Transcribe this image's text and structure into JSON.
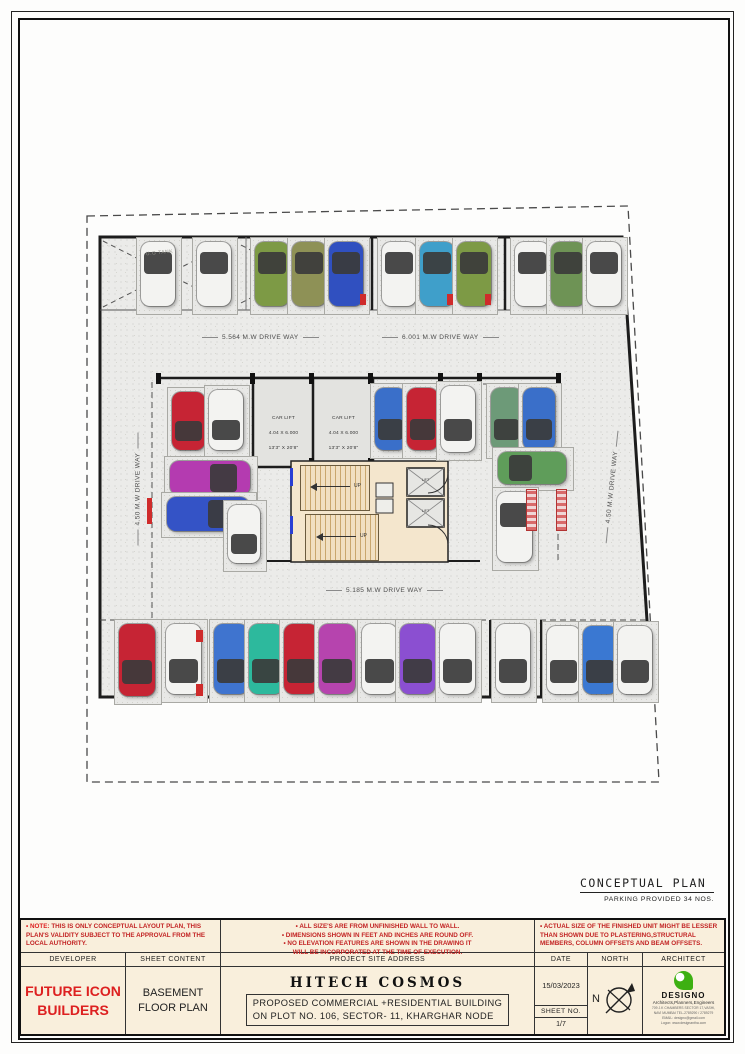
{
  "plan": {
    "conceptual_title": "CONCEPTUAL PLAN",
    "parking_note": "PARKING PROVIDED 34 NOS.",
    "tank_label": "U.G TANK",
    "up_label": "UP",
    "lift_label": "LIFT",
    "car_lift": {
      "line1": "CAR LIFT",
      "line2": "4.04 X 6.000",
      "line3": "13'3\" X 20'8\""
    },
    "driveways": [
      {
        "text": "5.564 M.W DRIVE WAY"
      },
      {
        "text": "6.001 M.W DRIVE WAY"
      },
      {
        "text": "4.50 M.W DRIVE WAY"
      },
      {
        "text": "4.50 M.W DRIVE WAY"
      },
      {
        "text": "5.185 M.W DRIVE WAY"
      }
    ],
    "cars": [
      {
        "x": 141,
        "y": 242,
        "w": 34,
        "h": 64,
        "c": "#f3f3f1",
        "o": "top"
      },
      {
        "x": 197,
        "y": 242,
        "w": 34,
        "h": 64,
        "c": "#f3f3f1",
        "o": "top"
      },
      {
        "x": 255,
        "y": 242,
        "w": 34,
        "h": 64,
        "c": "#7d9a45",
        "o": "top"
      },
      {
        "x": 292,
        "y": 242,
        "w": 34,
        "h": 64,
        "c": "#8e9156",
        "o": "top"
      },
      {
        "x": 329,
        "y": 242,
        "w": 34,
        "h": 64,
        "c": "#3050c0",
        "o": "top"
      },
      {
        "x": 382,
        "y": 242,
        "w": 34,
        "h": 64,
        "c": "#f3f3f1",
        "o": "top"
      },
      {
        "x": 420,
        "y": 242,
        "w": 34,
        "h": 64,
        "c": "#3f9fca",
        "o": "top"
      },
      {
        "x": 457,
        "y": 242,
        "w": 34,
        "h": 64,
        "c": "#7d9a45",
        "o": "top"
      },
      {
        "x": 515,
        "y": 242,
        "w": 34,
        "h": 64,
        "c": "#f3f3f1",
        "o": "top"
      },
      {
        "x": 551,
        "y": 242,
        "w": 34,
        "h": 64,
        "c": "#6e9355",
        "o": "top"
      },
      {
        "x": 587,
        "y": 242,
        "w": 34,
        "h": 64,
        "c": "#f3f3f1",
        "o": "top"
      },
      {
        "x": 172,
        "y": 392,
        "w": 33,
        "h": 58,
        "c": "#c62434",
        "o": "bottom"
      },
      {
        "x": 209,
        "y": 390,
        "w": 34,
        "h": 60,
        "c": "#f3f3f1",
        "o": "bottom"
      },
      {
        "x": 170,
        "y": 461,
        "w": 80,
        "h": 34,
        "c": "#b43bb0",
        "o": "right"
      },
      {
        "x": 167,
        "y": 497,
        "w": 82,
        "h": 34,
        "c": "#3453c6",
        "o": "right"
      },
      {
        "x": 228,
        "y": 505,
        "w": 32,
        "h": 58,
        "c": "#f3f3f1",
        "o": "bottom"
      },
      {
        "x": 375,
        "y": 388,
        "w": 31,
        "h": 62,
        "c": "#3a6fc9",
        "o": "bottom"
      },
      {
        "x": 407,
        "y": 388,
        "w": 31,
        "h": 62,
        "c": "#c62434",
        "o": "bottom"
      },
      {
        "x": 441,
        "y": 386,
        "w": 34,
        "h": 66,
        "c": "#f3f3f1",
        "o": "bottom"
      },
      {
        "x": 491,
        "y": 388,
        "w": 31,
        "h": 62,
        "c": "#6d9a78",
        "o": "bottom"
      },
      {
        "x": 523,
        "y": 388,
        "w": 32,
        "h": 62,
        "c": "#3a6fc9",
        "o": "bottom"
      },
      {
        "x": 498,
        "y": 452,
        "w": 68,
        "h": 32,
        "c": "#5f9d5a",
        "o": "left"
      },
      {
        "x": 497,
        "y": 492,
        "w": 35,
        "h": 70,
        "c": "#f3f3f1",
        "o": "top"
      },
      {
        "x": 119,
        "y": 624,
        "w": 36,
        "h": 72,
        "c": "#c62434",
        "o": "bottom"
      },
      {
        "x": 166,
        "y": 624,
        "w": 35,
        "h": 70,
        "c": "#f3f3f1",
        "o": "bottom"
      },
      {
        "x": 214,
        "y": 624,
        "w": 34,
        "h": 70,
        "c": "#3f74cf",
        "o": "bottom"
      },
      {
        "x": 249,
        "y": 624,
        "w": 34,
        "h": 70,
        "c": "#2db99d",
        "o": "bottom"
      },
      {
        "x": 284,
        "y": 624,
        "w": 34,
        "h": 70,
        "c": "#c62434",
        "o": "bottom"
      },
      {
        "x": 319,
        "y": 624,
        "w": 36,
        "h": 70,
        "c": "#b644ae",
        "o": "bottom"
      },
      {
        "x": 362,
        "y": 624,
        "w": 35,
        "h": 70,
        "c": "#f3f3f1",
        "o": "bottom"
      },
      {
        "x": 400,
        "y": 624,
        "w": 35,
        "h": 70,
        "c": "#8b4fd1",
        "o": "bottom"
      },
      {
        "x": 440,
        "y": 624,
        "w": 35,
        "h": 70,
        "c": "#f3f3f1",
        "o": "bottom"
      },
      {
        "x": 496,
        "y": 624,
        "w": 34,
        "h": 70,
        "c": "#f3f3f1",
        "o": "bottom"
      },
      {
        "x": 547,
        "y": 626,
        "w": 33,
        "h": 68,
        "c": "#f3f3f1",
        "o": "bottom"
      },
      {
        "x": 583,
        "y": 626,
        "w": 34,
        "h": 68,
        "c": "#3a78d2",
        "o": "bottom"
      },
      {
        "x": 618,
        "y": 626,
        "w": 34,
        "h": 68,
        "c": "#f3f3f1",
        "o": "bottom"
      }
    ]
  },
  "titleblock": {
    "notes_left_label": "NOTE:",
    "notes_left_text": "THIS IS ONLY CONCEPTUAL LAYOUT PLAN, THIS PLAN'S VALIDITY SUBJECT TO THE APPROVAL FROM THE LOCAL AUTHORITY.",
    "notes_mid": [
      "• ALL SIZE'S ARE FROM UNFINISHED WALL TO WALL.",
      "• DIMENSIONS SHOWN IN FEET AND INCHES ARE ROUND OFF.",
      "• NO ELEVATION FEATURES ARE SHOWN IN THE DRAWING IT",
      "WILL BE INCORPORATED AT THE TIME OF EXECUTION."
    ],
    "notes_right": "• ACTUAL SIZE OF THE FINISHED UNIT MIGHT BE LESSER THAN SHOWN DUE TO PLASTERING,STRUCTURAL MEMBERS, COLUMN OFFSETS AND BEAM OFFSETS.",
    "headers": {
      "developer": "DEVELOPER",
      "sheet_content": "SHEET CONTENT",
      "address": "PROJECT SITE ADDRESS",
      "date": "DATE",
      "north": "NORTH",
      "architect": "ARCHITECT",
      "sheet_no": "SHEET NO."
    },
    "developer_line1": "FUTURE ICON",
    "developer_line2": "BUILDERS",
    "sheet_content_line1": "BASEMENT",
    "sheet_content_line2": "FLOOR PLAN",
    "project_name": "HITECH COSMOS",
    "address_line1": "PROPOSED COMMERCIAL +RESIDENTIAL BUILDING",
    "address_line2": "ON PLOT NO. 106, SECTOR- 11, KHARGHAR NODE",
    "date_value": "15/03/2023",
    "sheet_no_value": "1/7",
    "north_letter": "N",
    "architect_name": "DESIGNO",
    "architect_sub": "Architects,Planners,Engineers",
    "architect_addr1": "709 J.K CHAMBERS SECTOR 17,VASHI,",
    "architect_addr2": "NAVI MUMBAI TEL-2789290 / 2789279",
    "architect_addr3": "EMAIL: designo@gmail.com",
    "architect_addr4": "Logon: www.designantha.com"
  }
}
